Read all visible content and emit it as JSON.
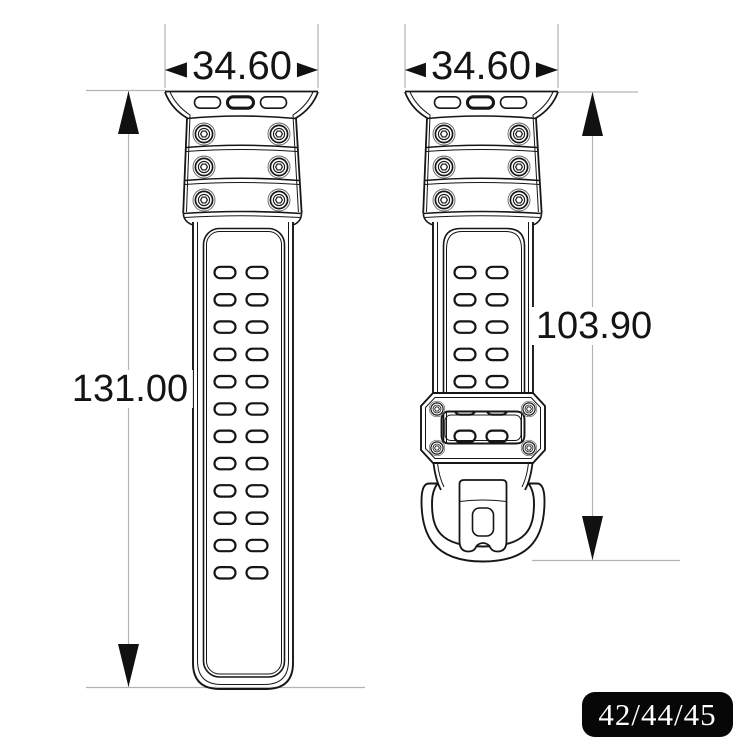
{
  "drawing": {
    "left_view": {
      "width_label": "34.60",
      "height_label": "131.00",
      "connector_slots": 3,
      "screw_rows": 3,
      "screws_per_row": 2,
      "hole_rows": 12,
      "hole_cols": 2
    },
    "right_view": {
      "width_label": "34.60",
      "height_label": "103.90",
      "connector_slots": 3,
      "screw_rows": 3,
      "screws_per_row": 2,
      "hole_rows": 7,
      "hole_cols": 2,
      "keeper_screws": 4
    },
    "badge_label": "42/44/45"
  },
  "colors": {
    "line": "#161616",
    "guide_line": "#b3b3b3",
    "arrow": "#111111",
    "badge_bg": "#070707",
    "badge_text": "#ffffff",
    "background": "#ffffff"
  }
}
